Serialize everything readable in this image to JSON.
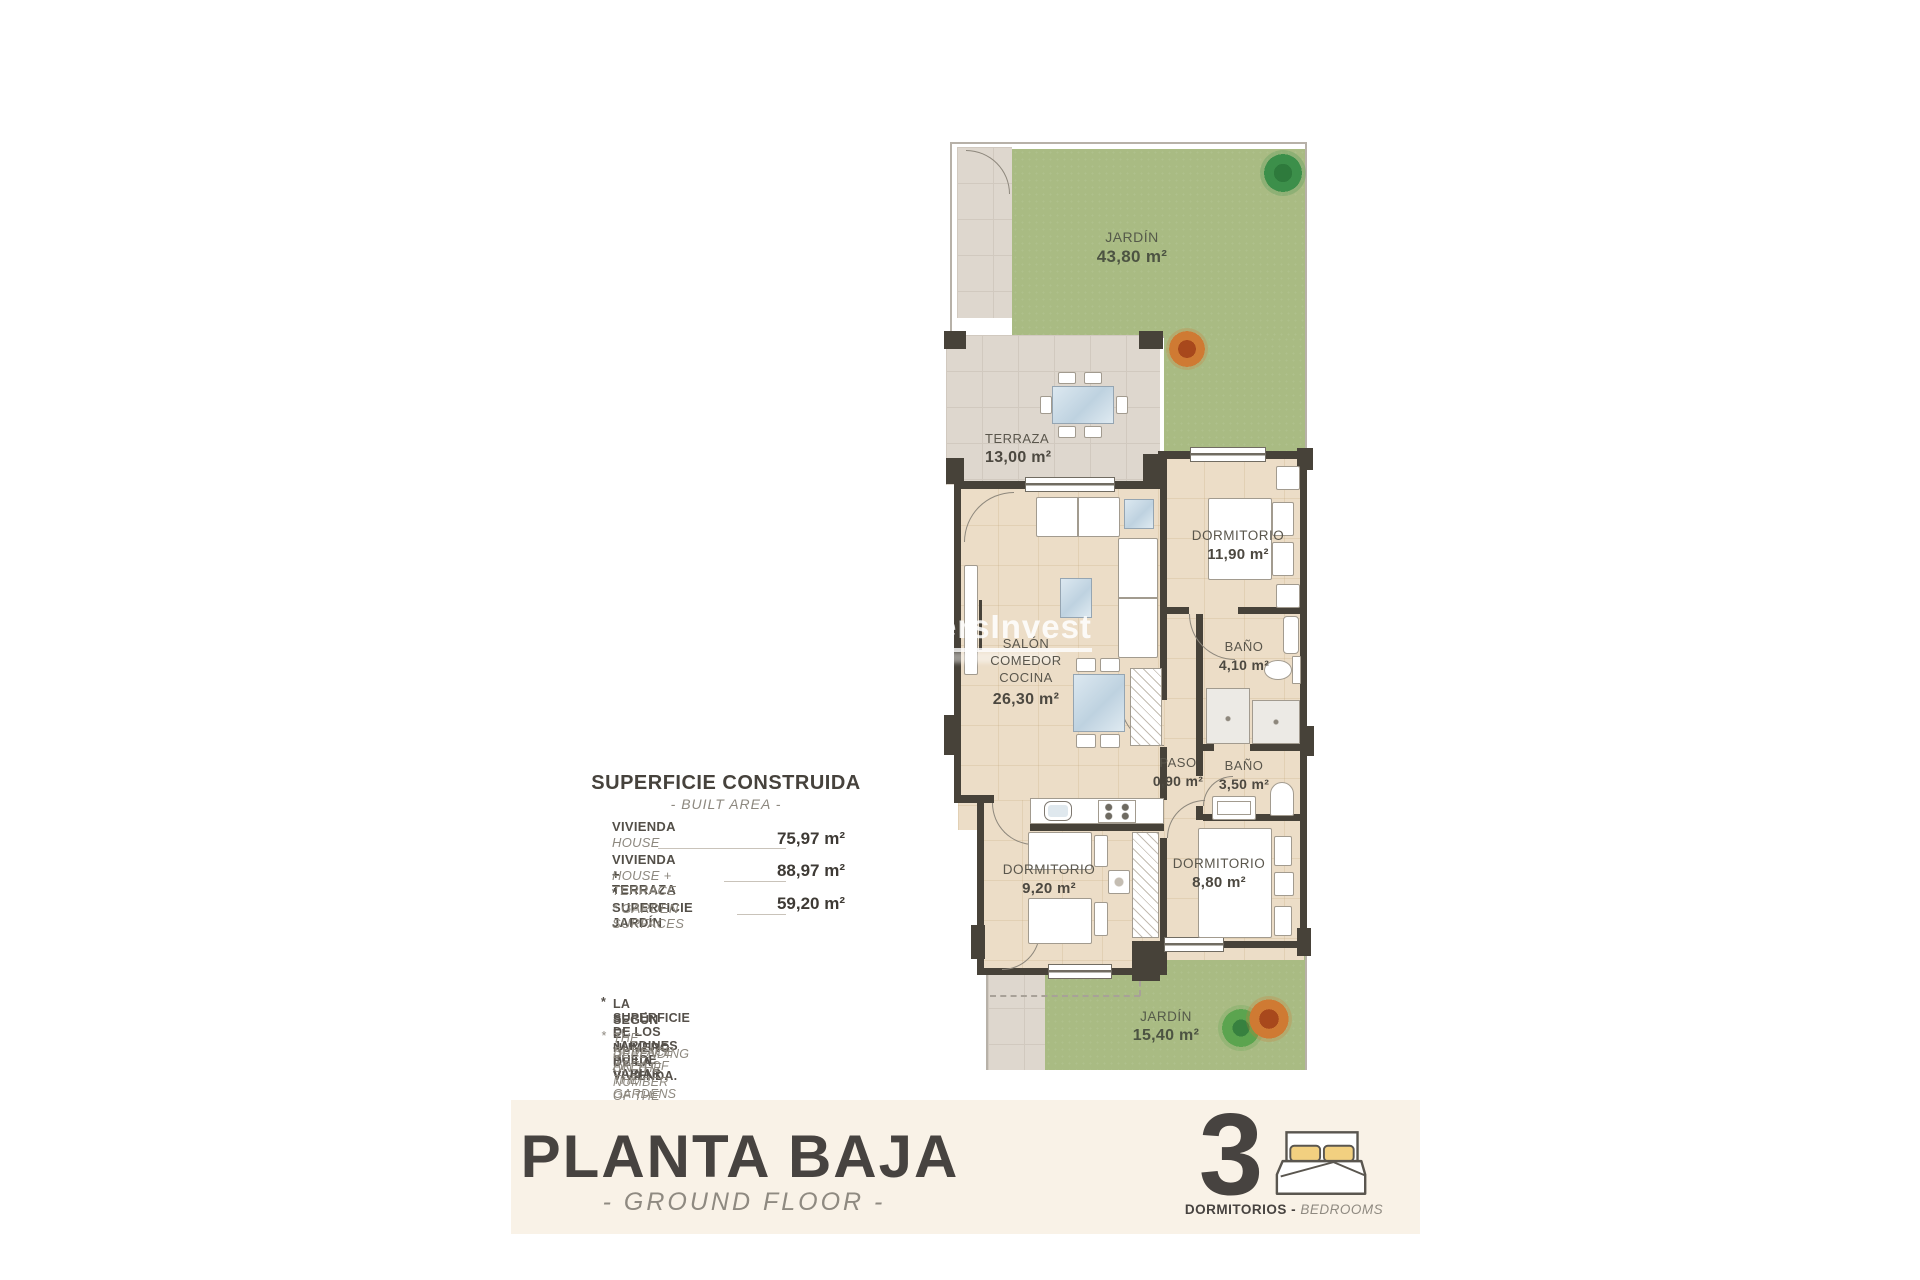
{
  "watermark": {
    "text": "ersInvest"
  },
  "plan": {
    "rooms": [
      {
        "id": "jardin-top",
        "name": "JARDÍN",
        "area": "43,80 m²"
      },
      {
        "id": "terraza",
        "name": "TERRAZA",
        "area": "13,00 m²"
      },
      {
        "id": "salon",
        "line1": "SALÓN",
        "line2": "COMEDOR",
        "line3": "COCINA",
        "area": "26,30 m²"
      },
      {
        "id": "dormitorio-1",
        "name": "DORMITORIO",
        "area": "11,90 m²"
      },
      {
        "id": "bano-1",
        "name": "BAÑO",
        "area": "4,10 m²"
      },
      {
        "id": "paso",
        "name": "PASO",
        "area": "0,90 m²"
      },
      {
        "id": "bano-2",
        "name": "BAÑO",
        "area": "3,50 m²"
      },
      {
        "id": "dormitorio-2",
        "name": "DORMITORIO",
        "area": "9,20 m²"
      },
      {
        "id": "dormitorio-3",
        "name": "DORMITORIO",
        "area": "8,80 m²"
      },
      {
        "id": "jardin-bottom",
        "name": "JARDÍN",
        "area": "15,40 m²"
      }
    ]
  },
  "summary": {
    "title": "SUPERFICIE CONSTRUIDA",
    "subtitle": "- BUILT AREA -",
    "rows": [
      {
        "label_es": "VIVIENDA",
        "label_en": "HOUSE",
        "value": "75,97 m²"
      },
      {
        "label_es": "VIVIENDA + TERRAZA",
        "label_en": "HOUSE + TERRACE",
        "value": "88,97 m²"
      },
      {
        "label_es": "* SUPERFICIE JARDÍN",
        "label_en": "* GARDEN SURFACES",
        "value": "59,20 m²"
      }
    ]
  },
  "footnote": {
    "marker": "*",
    "es_line1": "LA SUPERFICIE DE LOS JARDINES PUEDE VARIAR",
    "es_line2": "SEGÚN EL NUMERO DE LA VIVIENDA.",
    "en_line1": "THE SURFACE AREA OF THE GARDENS MAY VARY",
    "en_line2": "DEPENDING ON THE NUMBER OF THE HOME."
  },
  "footer": {
    "title": "PLANTA BAJA",
    "subtitle": "- GROUND FLOOR -",
    "bedrooms_count": "3",
    "bedrooms_label_es": "DORMITORIOS -",
    "bedrooms_label_en": "BEDROOMS"
  },
  "colors": {
    "grass": "#a9bb83",
    "floor": "#ecddc7",
    "tile": "#ded7ce",
    "wall": "#474239",
    "footer_bar": "#f9f2e7",
    "pillow_accent": "#f2d080",
    "text_dark": "#474340",
    "text_muted": "#8d887f"
  }
}
